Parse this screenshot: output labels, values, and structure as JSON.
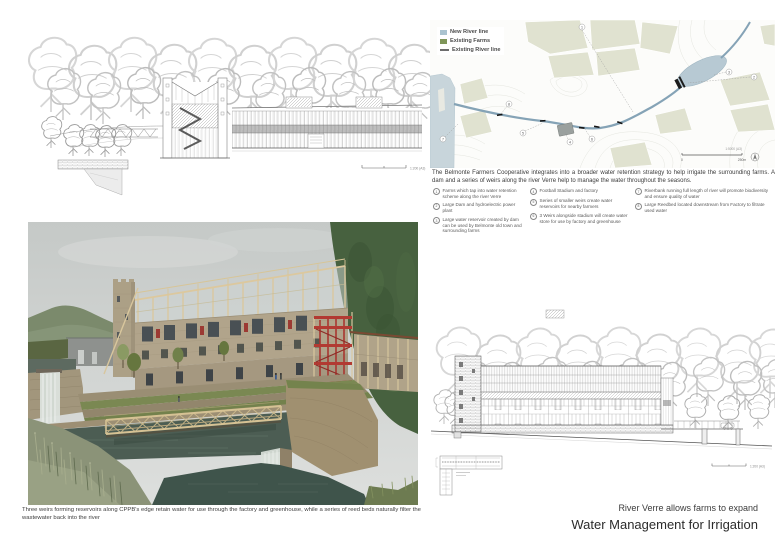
{
  "titles": {
    "subtitle": "River Verre allows farms to expand",
    "title": "Water Management for Irrigation"
  },
  "map": {
    "legend": [
      {
        "label": "New River line",
        "color": "#aac3cf"
      },
      {
        "label": "Existing Farms",
        "color": "#7f9659"
      },
      {
        "label": "Existing River line",
        "color": "#6d6d6d"
      }
    ],
    "paragraph": "The Belmonte Farmers Cooperative integrates into a broader water retention strategy to help irrigate the surrounding farms. A dam and a series of weirs along the river Verre help to manage the water throughout the seasons.",
    "scale_label": "1:5000 (A3)",
    "scale_zero": "0",
    "scale_dist": "250m"
  },
  "key_items": [
    {
      "num": "1",
      "text": "Farms which tap into water retention scheme along the river Verre"
    },
    {
      "num": "2",
      "text": "Large Dam and hydroelectric power plant"
    },
    {
      "num": "3",
      "text": "Large water reservoir created by dam can be used by Belmonte old town and surrounding farms"
    },
    {
      "num": "4",
      "text": "Football Stadium and factory"
    },
    {
      "num": "5",
      "text": "Series of smaller weirs create water reservoirs for nearby farmers"
    },
    {
      "num": "6",
      "text": "3 Weirs alongside stadium will create water store for use by factory and greenhouse"
    },
    {
      "num": "7",
      "text": "Riverbank running full length of river will promote biodiversity and ensure quality of water"
    },
    {
      "num": "8",
      "text": "Large Reedbed located downstream from Factory to filtrate used water"
    }
  ],
  "render_caption": "Three weirs forming reservoirs along CPPB's edge retain water for use through the factory and greenhouse, while a series of reed beds naturally filter the wastewater back into the river",
  "elev_top": {
    "scale_label": "1:200 (A3)"
  },
  "elev_bottom": {
    "scale_label": "1:200 (A3)"
  },
  "colors": {
    "map_water": "#b7c9d3",
    "map_farms": "#e0e2d0",
    "stair_red": "#a83630",
    "render_water": "#4c5d53",
    "timber": "#d6c294"
  }
}
